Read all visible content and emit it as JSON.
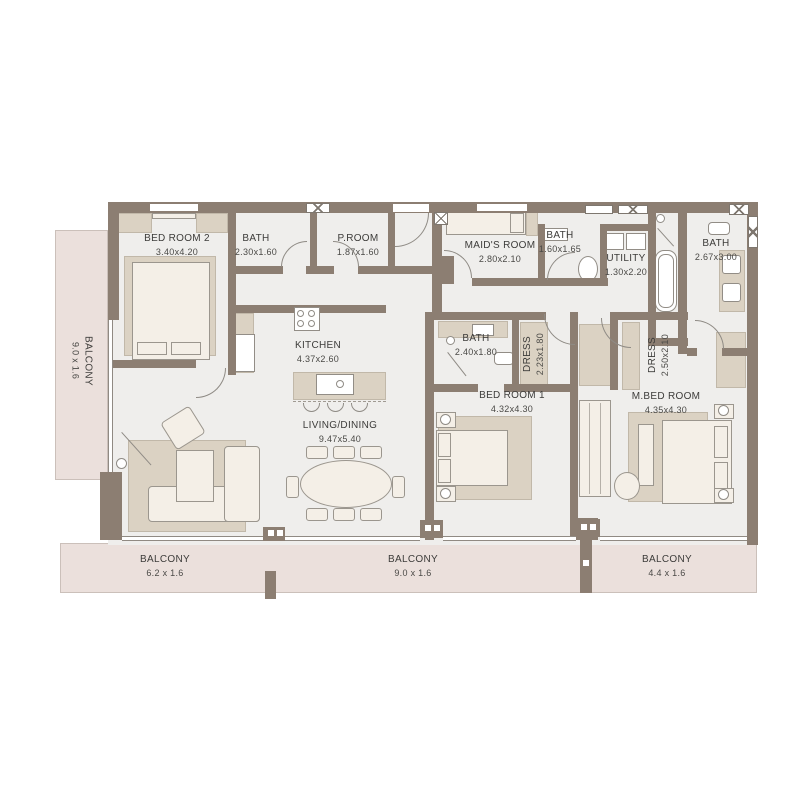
{
  "plan": {
    "type": "apartment-floor-plan",
    "rooms": [
      {
        "name": "BED ROOM 2",
        "dims": "3.40x4.20"
      },
      {
        "name": "BATH",
        "dims": "2.30x1.60"
      },
      {
        "name": "P.ROOM",
        "dims": "1.87x1.60"
      },
      {
        "name": "MAID'S ROOM",
        "dims": "2.80x2.10"
      },
      {
        "name": "BATH",
        "dims": "1.60x1.65"
      },
      {
        "name": "UTILITY",
        "dims": "1.30x2.20"
      },
      {
        "name": "BATH",
        "dims": "2.67x3.00"
      },
      {
        "name": "KITCHEN",
        "dims": "4.37x2.60"
      },
      {
        "name": "LIVING/DINING",
        "dims": "9.47x5.40"
      },
      {
        "name": "BATH",
        "dims": "2.40x1.80"
      },
      {
        "name": "DRESS",
        "dims": "2.23x1.80"
      },
      {
        "name": "BED ROOM 1",
        "dims": "4.32x4.30"
      },
      {
        "name": "DRESS",
        "dims": "2.50x2.10"
      },
      {
        "name": "M.BED ROOM",
        "dims": "4.35x4.30"
      }
    ],
    "balconies": [
      {
        "name": "BALCONY",
        "dims": "9.0 x 1.6",
        "orientation": "vertical-left"
      },
      {
        "name": "BALCONY",
        "dims": "6.2 x 1.6",
        "orientation": "bottom"
      },
      {
        "name": "BALCONY",
        "dims": "9.0 x 1.6",
        "orientation": "bottom"
      },
      {
        "name": "BALCONY",
        "dims": "4.4 x 1.6",
        "orientation": "bottom"
      }
    ],
    "colors": {
      "wall": "#8c7e72",
      "floor": "#efeeec",
      "balcony": "#ebe0dc",
      "furniture": "#f4efe7",
      "accent_tan": "#dbd2c3",
      "line": "#8f8b85",
      "text": "#3d3c3a"
    }
  }
}
